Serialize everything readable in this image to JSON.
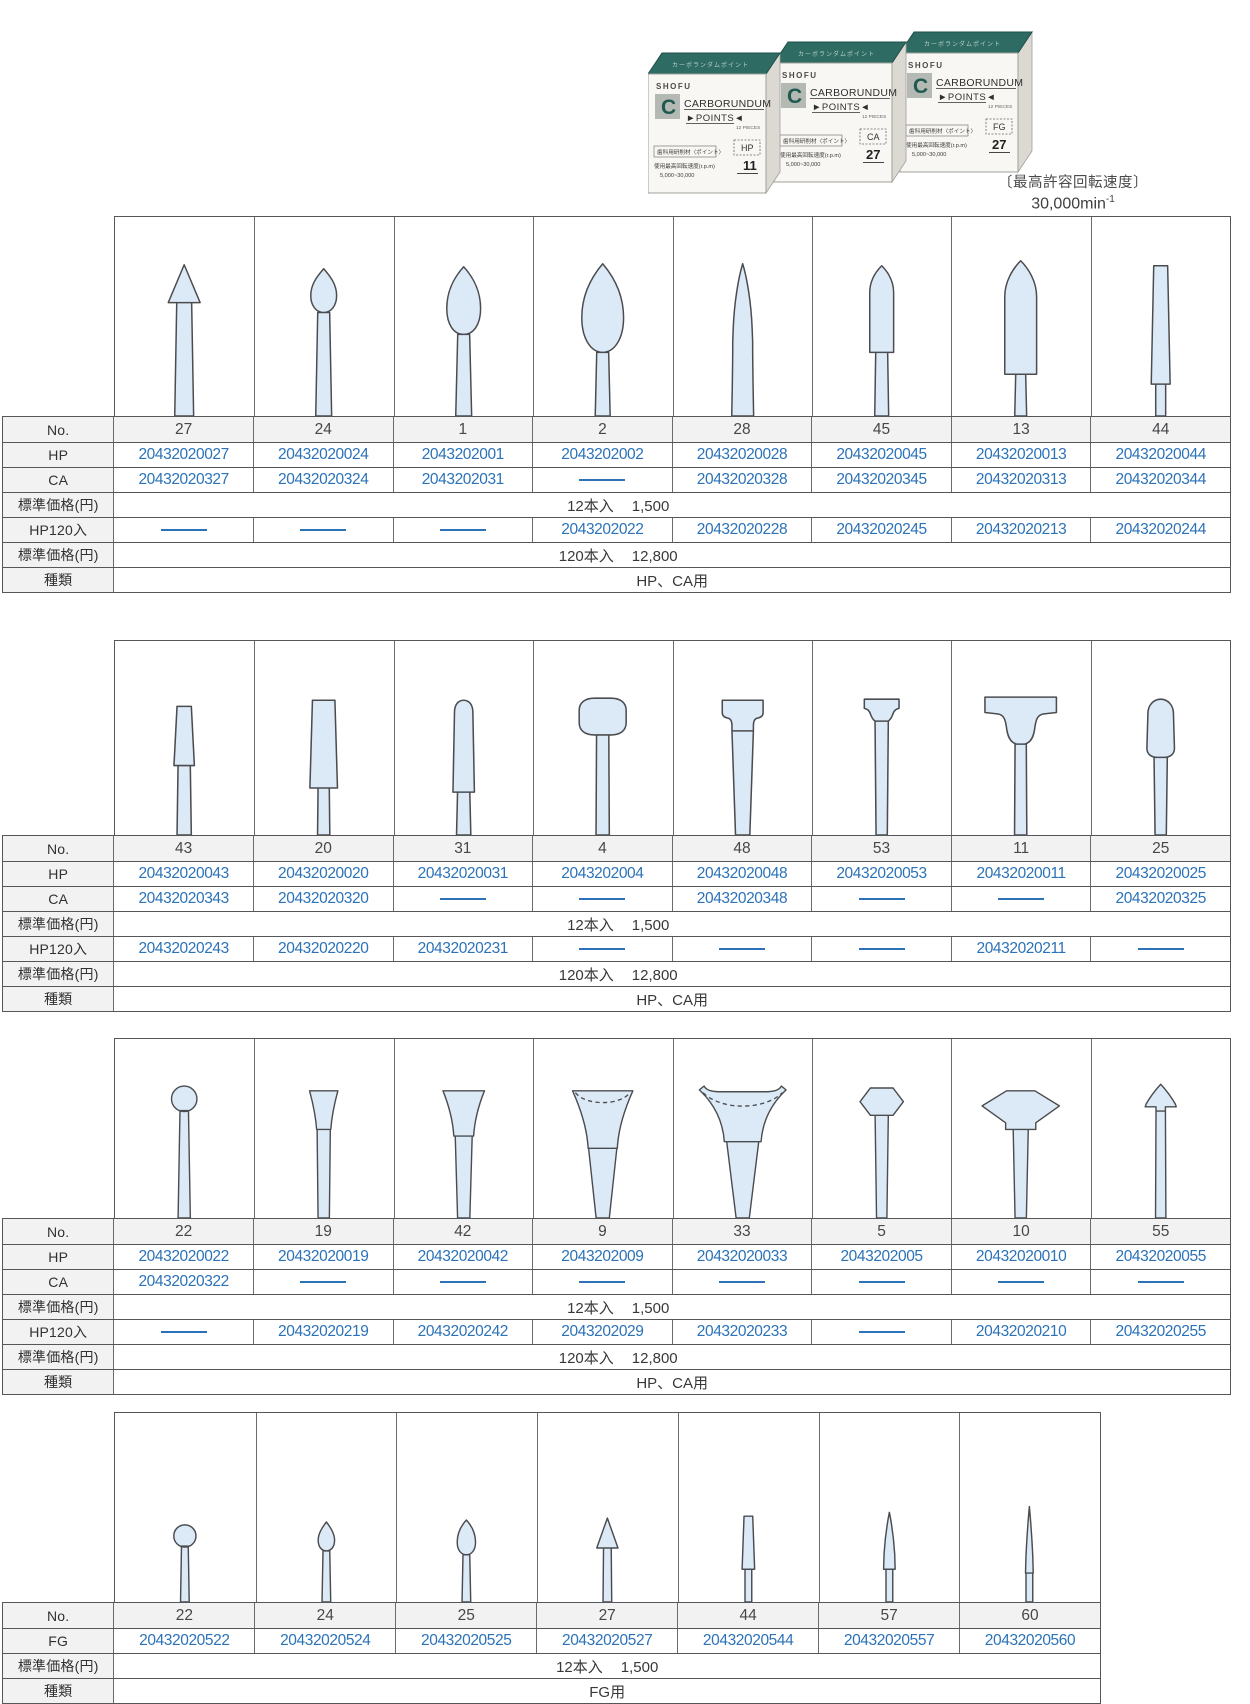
{
  "header": {
    "speed_caption": "〔最高許容回転速度〕",
    "speed_value": "30,000min",
    "speed_exp": "-1",
    "boxes": {
      "brand": "SHOFU",
      "name1": "CARBORUNDUM",
      "name2": "►POINTS◄",
      "pieces": "12 PIECES",
      "top_text": "カーボランダムポイント",
      "jp_label": "歯科用研削材〈ポイント〉",
      "jp_speed": "使用最高回転速度(r.p.m)",
      "jp_range": "5,000~30,000",
      "variants": [
        {
          "type": "HP",
          "no": "11"
        },
        {
          "type": "CA",
          "no": "27"
        },
        {
          "type": "FG",
          "no": "27"
        }
      ]
    }
  },
  "row_labels": {
    "no": "No.",
    "hp": "HP",
    "ca": "CA",
    "fg": "FG",
    "price": "標準価格(円)",
    "hp120": "HP120入",
    "kind": "種類"
  },
  "tables": [
    {
      "id": 1,
      "rows": [
        "no",
        "hp",
        "ca",
        "price12",
        "hp120",
        "price120",
        "kind"
      ],
      "price12_qty": "12本入",
      "price12_val": "1,500",
      "price120_qty": "120本入",
      "price120_val": "12,800",
      "kind": "HP、CA用",
      "columns": [
        {
          "no": "27",
          "shape": "cone",
          "hp": "20432020027",
          "ca": "20432020327",
          "hp120": null
        },
        {
          "no": "24",
          "shape": "flame-small",
          "hp": "20432020024",
          "ca": "20432020324",
          "hp120": null
        },
        {
          "no": "1",
          "shape": "egg",
          "hp": "2043202001",
          "ca": "2043202031",
          "hp120": null
        },
        {
          "no": "2",
          "shape": "flame-large",
          "hp": "2043202002",
          "ca": null,
          "hp120": "2043202022"
        },
        {
          "no": "28",
          "shape": "taper-point",
          "hp": "20432020028",
          "ca": "20432020328",
          "hp120": "20432020228"
        },
        {
          "no": "45",
          "shape": "bullet",
          "hp": "20432020045",
          "ca": "20432020345",
          "hp120": "20432020245"
        },
        {
          "no": "13",
          "shape": "torpedo",
          "hp": "20432020013",
          "ca": "20432020313",
          "hp120": "20432020213"
        },
        {
          "no": "44",
          "shape": "taper-flat",
          "hp": "20432020044",
          "ca": "20432020344",
          "hp120": "20432020244"
        }
      ]
    },
    {
      "id": 2,
      "rows": [
        "no",
        "hp",
        "ca",
        "price12",
        "hp120",
        "price120",
        "kind"
      ],
      "price12_qty": "12本入",
      "price12_val": "1,500",
      "price120_qty": "120本入",
      "price120_val": "12,800",
      "kind": "HP、CA用",
      "columns": [
        {
          "no": "43",
          "shape": "trunc-cone-small",
          "hp": "20432020043",
          "ca": "20432020343",
          "hp120": "20432020243"
        },
        {
          "no": "20",
          "shape": "trunc-cone-large",
          "hp": "20432020020",
          "ca": "20432020320",
          "hp120": "20432020220"
        },
        {
          "no": "31",
          "shape": "dome-cylinder",
          "hp": "20432020031",
          "ca": null,
          "hp120": "20432020231"
        },
        {
          "no": "4",
          "shape": "nail-head",
          "hp": "2043202004",
          "ca": null,
          "hp120": null
        },
        {
          "no": "48",
          "shape": "t-flange-med",
          "hp": "20432020048",
          "ca": "20432020348",
          "hp120": null
        },
        {
          "no": "53",
          "shape": "t-flange-small",
          "hp": "20432020053",
          "ca": null,
          "hp120": null
        },
        {
          "no": "11",
          "shape": "t-flange-large",
          "hp": "20432020011",
          "ca": null,
          "hp120": "20432020211"
        },
        {
          "no": "25",
          "shape": "bud",
          "hp": "20432020025",
          "ca": "20432020325",
          "hp120": null
        }
      ]
    },
    {
      "id": 3,
      "rows": [
        "no",
        "hp",
        "ca",
        "price12",
        "hp120",
        "price120",
        "kind"
      ],
      "price12_qty": "12本入",
      "price12_val": "1,500",
      "price120_qty": "120本入",
      "price120_val": "12,800",
      "kind": "HP、CA用",
      "columns": [
        {
          "no": "22",
          "shape": "ball",
          "hp": "20432020022",
          "ca": "20432020322",
          "hp120": null
        },
        {
          "no": "19",
          "shape": "inv-cone-small",
          "hp": "20432020019",
          "ca": null,
          "hp120": "20432020219"
        },
        {
          "no": "42",
          "shape": "inv-cone-med",
          "hp": "20432020042",
          "ca": null,
          "hp120": "20432020242"
        },
        {
          "no": "9",
          "shape": "cup",
          "hp": "2043202009",
          "ca": null,
          "hp120": "2043202029"
        },
        {
          "no": "33",
          "shape": "cup-wide",
          "hp": "20432020033",
          "ca": null,
          "hp120": "20432020233"
        },
        {
          "no": "5",
          "shape": "hex-barrel",
          "hp": "2043202005",
          "ca": null,
          "hp120": null
        },
        {
          "no": "10",
          "shape": "knife-wheel",
          "hp": "20432020010",
          "ca": null,
          "hp120": "20432020210"
        },
        {
          "no": "55",
          "shape": "spear",
          "hp": "20432020055",
          "ca": null,
          "hp120": "20432020255"
        }
      ]
    },
    {
      "id": 4,
      "rows": [
        "no",
        "fg",
        "price12",
        "kind"
      ],
      "price12_qty": "12本入",
      "price12_val": "1,500",
      "kind": "FG用",
      "columns": [
        {
          "no": "22",
          "shape": "ball-fg",
          "fg": "20432020522"
        },
        {
          "no": "24",
          "shape": "flame-fg",
          "fg": "20432020524"
        },
        {
          "no": "25",
          "shape": "egg-fg",
          "fg": "20432020525"
        },
        {
          "no": "27",
          "shape": "cone-fg",
          "fg": "20432020527"
        },
        {
          "no": "44",
          "shape": "taper-flat-fg",
          "fg": "20432020544"
        },
        {
          "no": "57",
          "shape": "taper-point-fg",
          "fg": "20432020557"
        },
        {
          "no": "60",
          "shape": "needle-fg",
          "fg": "20432020560"
        }
      ]
    }
  ]
}
